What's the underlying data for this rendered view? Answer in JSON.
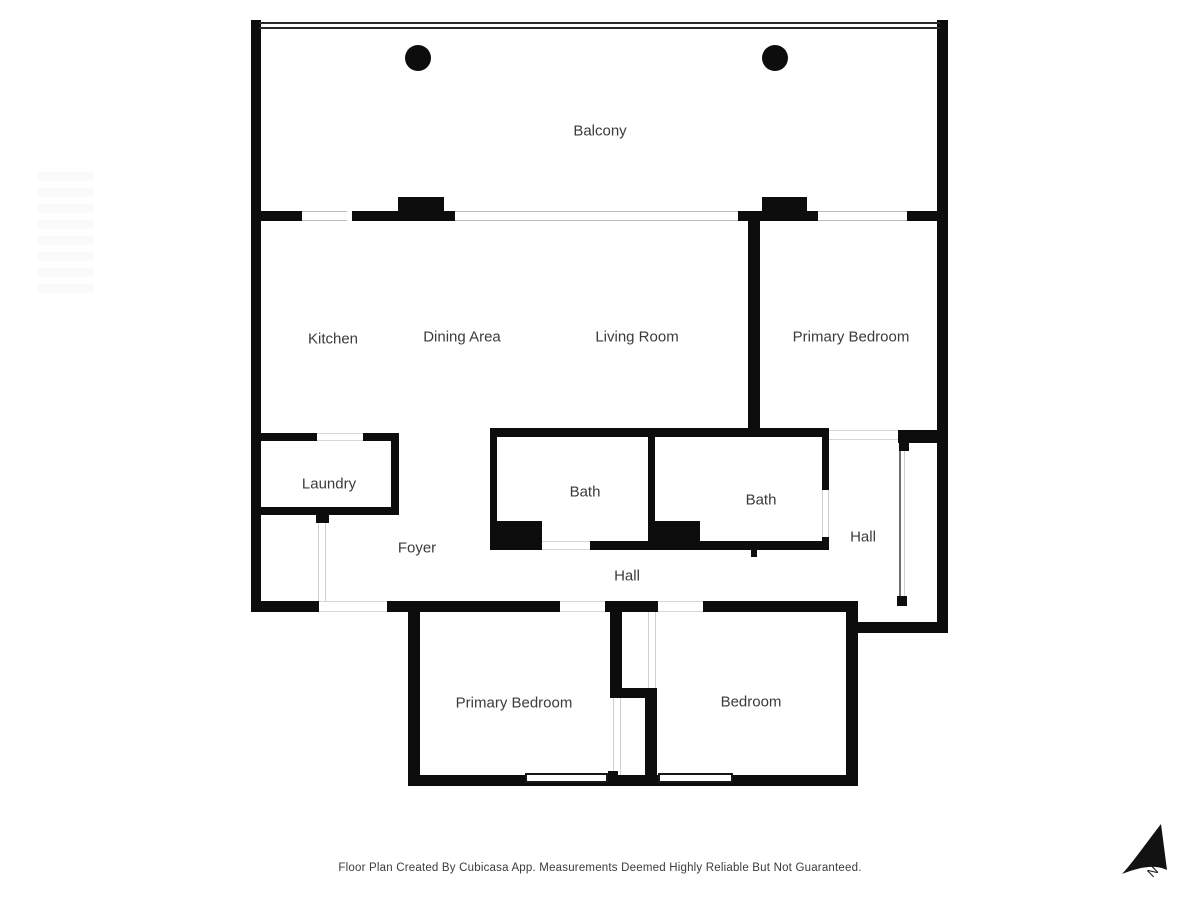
{
  "rooms": {
    "balcony": {
      "label": "Balcony"
    },
    "kitchen": {
      "label": "Kitchen"
    },
    "dining_area": {
      "label": "Dining Area"
    },
    "living_room": {
      "label": "Living Room"
    },
    "primary_bedroom_right": {
      "label": "Primary Bedroom"
    },
    "laundry": {
      "label": "Laundry"
    },
    "bath_left": {
      "label": "Bath"
    },
    "bath_right": {
      "label": "Bath"
    },
    "hall_right": {
      "label": "Hall"
    },
    "foyer": {
      "label": "Foyer"
    },
    "hall_center": {
      "label": "Hall"
    },
    "primary_bedroom_bottom": {
      "label": "Primary Bedroom"
    },
    "bedroom": {
      "label": "Bedroom"
    }
  },
  "footer": {
    "disclaimer": "Floor Plan Created By Cubicasa App. Measurements Deemed Highly Reliable But Not Guaranteed."
  },
  "compass": {
    "label": "N"
  },
  "colors": {
    "wall": "#0d0d0d",
    "text": "#3b3b3b",
    "background": "#ffffff"
  }
}
